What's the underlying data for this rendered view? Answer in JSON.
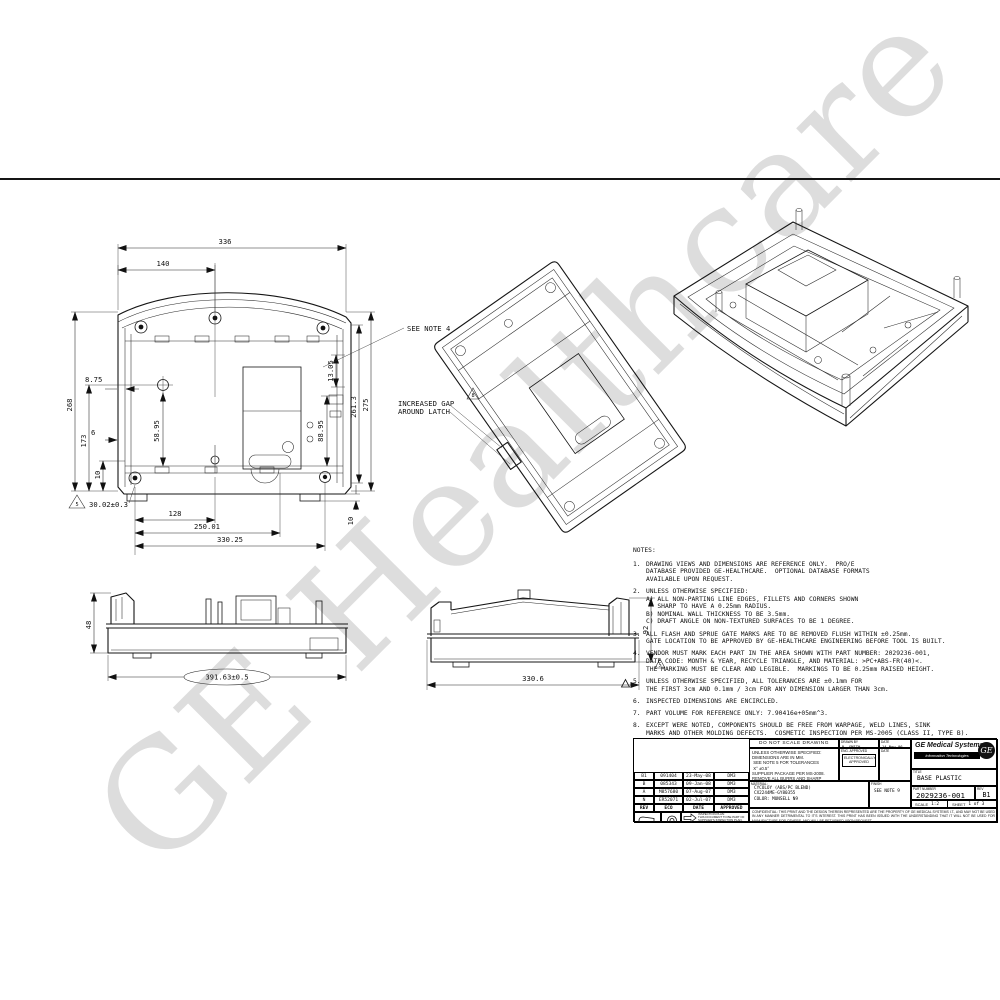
{
  "watermark": "GE Healthcare",
  "notes": {
    "heading": "NOTES:",
    "items": [
      {
        "num": "1.",
        "text": "DRAWING VIEWS AND DIMENSIONS ARE REFERENCE ONLY.  PRO/E\nDATABASE PROVIDED GE-HEALTHCARE.  OPTIONAL DATABASE FORMATS\nAVAILABLE UPON REQUEST."
      },
      {
        "num": "2.",
        "text": "UNLESS OTHERWISE SPECIFIED:\nA) ALL NON-PARTING LINE EDGES, FILLETS AND CORNERS SHOWN\n   SHARP TO HAVE A 0.25mm RADIUS.\nB) NOMINAL WALL THICKNESS TO BE 3.5mm.\nC) DRAFT ANGLE ON NON-TEXTURED SURFACES TO BE 1 DEGREE."
      },
      {
        "num": "3.",
        "text": "ALL FLASH AND SPRUE GATE MARKS ARE TO BE REMOVED FLUSH WITHIN ±0.25mm.\nGATE LOCATION TO BE APPROVED BY GE-HEALTHCARE ENGINEERING BEFORE TOOL IS BUILT."
      },
      {
        "num": "4.",
        "text": "VENDOR MUST MARK EACH PART IN THE AREA SHOWN WITH PART NUMBER: 2029236-001,\nDATE CODE: MONTH & YEAR, RECYCLE TRIANGLE, AND MATERIAL: >PC+ABS-FR(40)<.\nTHE MARKING MUST BE CLEAR AND LEGIBLE.  MARKINGS TO BE 0.25mm RAISED HEIGHT."
      },
      {
        "num": "5.",
        "text": "UNLESS OTHERWISE SPECIFIED, ALL TOLERANCES ARE ±0.1mm FOR\nTHE FIRST 3cm AND 0.1mm / 3cm FOR ANY DIMENSION LARGER THAN 3cm."
      },
      {
        "num": "6.",
        "text": "INSPECTED DIMENSIONS ARE ENCIRCLED."
      },
      {
        "num": "7.",
        "text": "PART VOLUME FOR REFERENCE ONLY: 7.90416e+05mm^3."
      },
      {
        "num": "8.",
        "text": "EXCEPT WERE NOTED, COMPONENTS SHOULD BE FREE FROM WARPAGE, WELD LINES, SINK\nMARKS AND OTHER MOLDING DEFECTS.  COSMETIC INSPECTION PER MS-2005 (CLASS II, TYPE B)."
      },
      {
        "num": "9.",
        "text": "TEXTURED PER MOLD-TECH MT-1055-4, 0.023mm DEEP.  SURFACES MARKED \"T\" TO BE TEXTURED."
      }
    ]
  },
  "views": {
    "plan": {
      "see_note": "SEE NOTE 4",
      "flag": "5",
      "flag_text": "30.02±0.3",
      "d336": "336",
      "d140": "140",
      "d875": "8.75",
      "d6": "6",
      "d268": "268",
      "d173": "173",
      "d10l": "10",
      "d5895": "58.95",
      "d8895": "88.95",
      "d1305": "13.05",
      "d2613": "261.3",
      "d275": "275",
      "d128": "128",
      "d25001": "250.01",
      "d33025": "330.25",
      "d10r": "10"
    },
    "tilted": {
      "flag": "8",
      "callout1": "INCREASED GAP",
      "callout2": "AROUND LATCH"
    },
    "front": {
      "d48": "48",
      "d391": "391.63±0.5"
    },
    "side": {
      "d3306": "330.6",
      "d92": "92",
      "flag": "5"
    }
  },
  "revisions": {
    "headers": [
      "REV",
      "ECO",
      "DATE",
      "APPROVED"
    ],
    "rows": [
      [
        "B1",
        "091404",
        "23-May-08",
        "DM3"
      ],
      [
        "B",
        "085343",
        "09-Jan-08",
        "DM3"
      ],
      [
        "A",
        "M857680",
        "07-Aug-07",
        "DM3"
      ],
      [
        "N",
        "ER52071",
        "02-Jul-07",
        "DM3"
      ]
    ]
  },
  "title_block": {
    "do_not_scale": "DO NOT SCALE DRAWING",
    "drawn_by_label": "DRAWN BY",
    "drawn_by": "R. SMITH",
    "date_label": "DATE",
    "drawn_date": "14-Nov-06",
    "eng_label": "ENG. APPROVED",
    "eng_stamp": "ELECTRONICALLY\nAPPROVED",
    "date2_label": "DATE",
    "specs": "UNLESS OTHERWISE SPECIFIED:\nDIMENSIONS ARE IN MM.\n SEE NOTE 5 FOR TOLERANCES\n X° ±0.5°\nSUPPLIER PACKAGE PER MS-2008.\nREMOVE ALL BURRS AND SHARP EDGES.",
    "material_label": "MATERIAL:",
    "material": "CYCOLOY (ABS/PC BLEND)\nCX2244ME-GY80355\nCOLOR: MUNSELL N9",
    "finish_label": "FINISH",
    "finish": "SEE NOTE 9",
    "company": "GE Medical Systems",
    "division": "Information Technologies",
    "monogram": "GE",
    "title_label": "TITLE",
    "title": "BASE PLASTIC",
    "part_number_label": "PART NUMBER",
    "part_number": "2029236-001",
    "rev_label": "REV",
    "rev": "B1",
    "scale_label": "SCALE",
    "scale": "1:2",
    "sheet_label": "SHEET",
    "sheet": "1 of 3",
    "confidential": "CONFIDENTIAL: THIS PRINT AND THE DESIGN THEREIN REPRESENTED ARE THE PROPERTY OF GE MEDICAL SYSTEMS I.T., AND MAY NOT BE USED IN ANY MANNER DETRIMENTAL TO IT'S INTEREST. THIS PRINT HAS BEEN ISSUED WITH THE UNDERSTANDING THAT IT WILL NOT BE USED FOR MANUFACTURE FOR OTHERS, AND WILL BE RETURNED UPON REQUEST.",
    "inspection_plan": "INSPECTION PLAN:\nTHIS DOCUMENT TO BE PART OF\nSUPPLIER'S INSPECTION PLAN."
  }
}
